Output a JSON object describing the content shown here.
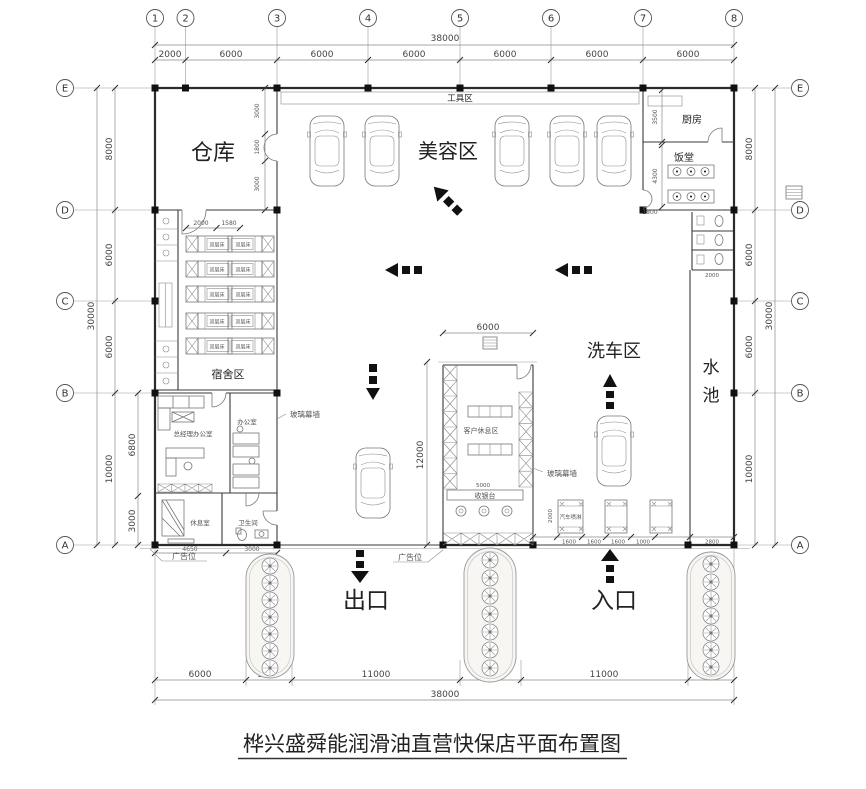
{
  "title": "桦兴盛舜能润滑油直营快保店平面布置图",
  "axes": {
    "cols": [
      "1",
      "2",
      "3",
      "4",
      "5",
      "6",
      "7",
      "8"
    ],
    "rows": [
      "E",
      "D",
      "C",
      "B",
      "A"
    ]
  },
  "dims": {
    "top_total": "38000",
    "top": [
      "2000",
      "6000",
      "6000",
      "6000",
      "6000",
      "6000",
      "6000"
    ],
    "bottom": [
      "6000",
      "3000",
      "11000",
      "4000",
      "11000",
      "3000"
    ],
    "bottom_total": "38000",
    "side_total": "30000",
    "side": [
      "8000",
      "6000",
      "6000",
      "10000"
    ],
    "office_inner": [
      "6800",
      "3000"
    ],
    "office_bottom": [
      "4650",
      "3000"
    ],
    "warehouse_door": [
      "3000",
      "1800",
      "3000"
    ],
    "kitchen_depth": "3500",
    "dining_depth": "4300",
    "dining_door": "1800",
    "dorm_top": [
      "2000",
      "1580"
    ],
    "lounge_width": "6000",
    "lounge_height": "12000",
    "cashier_width": "5000",
    "toilet_width": "2000",
    "spray_depth": "2000",
    "spray": [
      "1600",
      "1600",
      "1600",
      "1000",
      "2800"
    ]
  },
  "labels": {
    "warehouse": "仓库",
    "tool_area": "工具区",
    "beauty_area": "美容区",
    "kitchen": "厨房",
    "dining_hall": "饭堂",
    "wash_area": "洗车区",
    "water_pool": "水池",
    "dorm_area": "宿舍区",
    "bunk_bed": "双层床",
    "gm_office": "总经理办公室",
    "office": "办公室",
    "rest_room": "休息室",
    "toilet": "卫生间",
    "customer_lounge": "客户休息区",
    "cashier_desk": "收银台",
    "glass_curtain_wall": "玻璃幕墙",
    "car_spray": "汽车喷淋",
    "exit": "出口",
    "entrance": "入口",
    "ad_spot": "广告位"
  }
}
